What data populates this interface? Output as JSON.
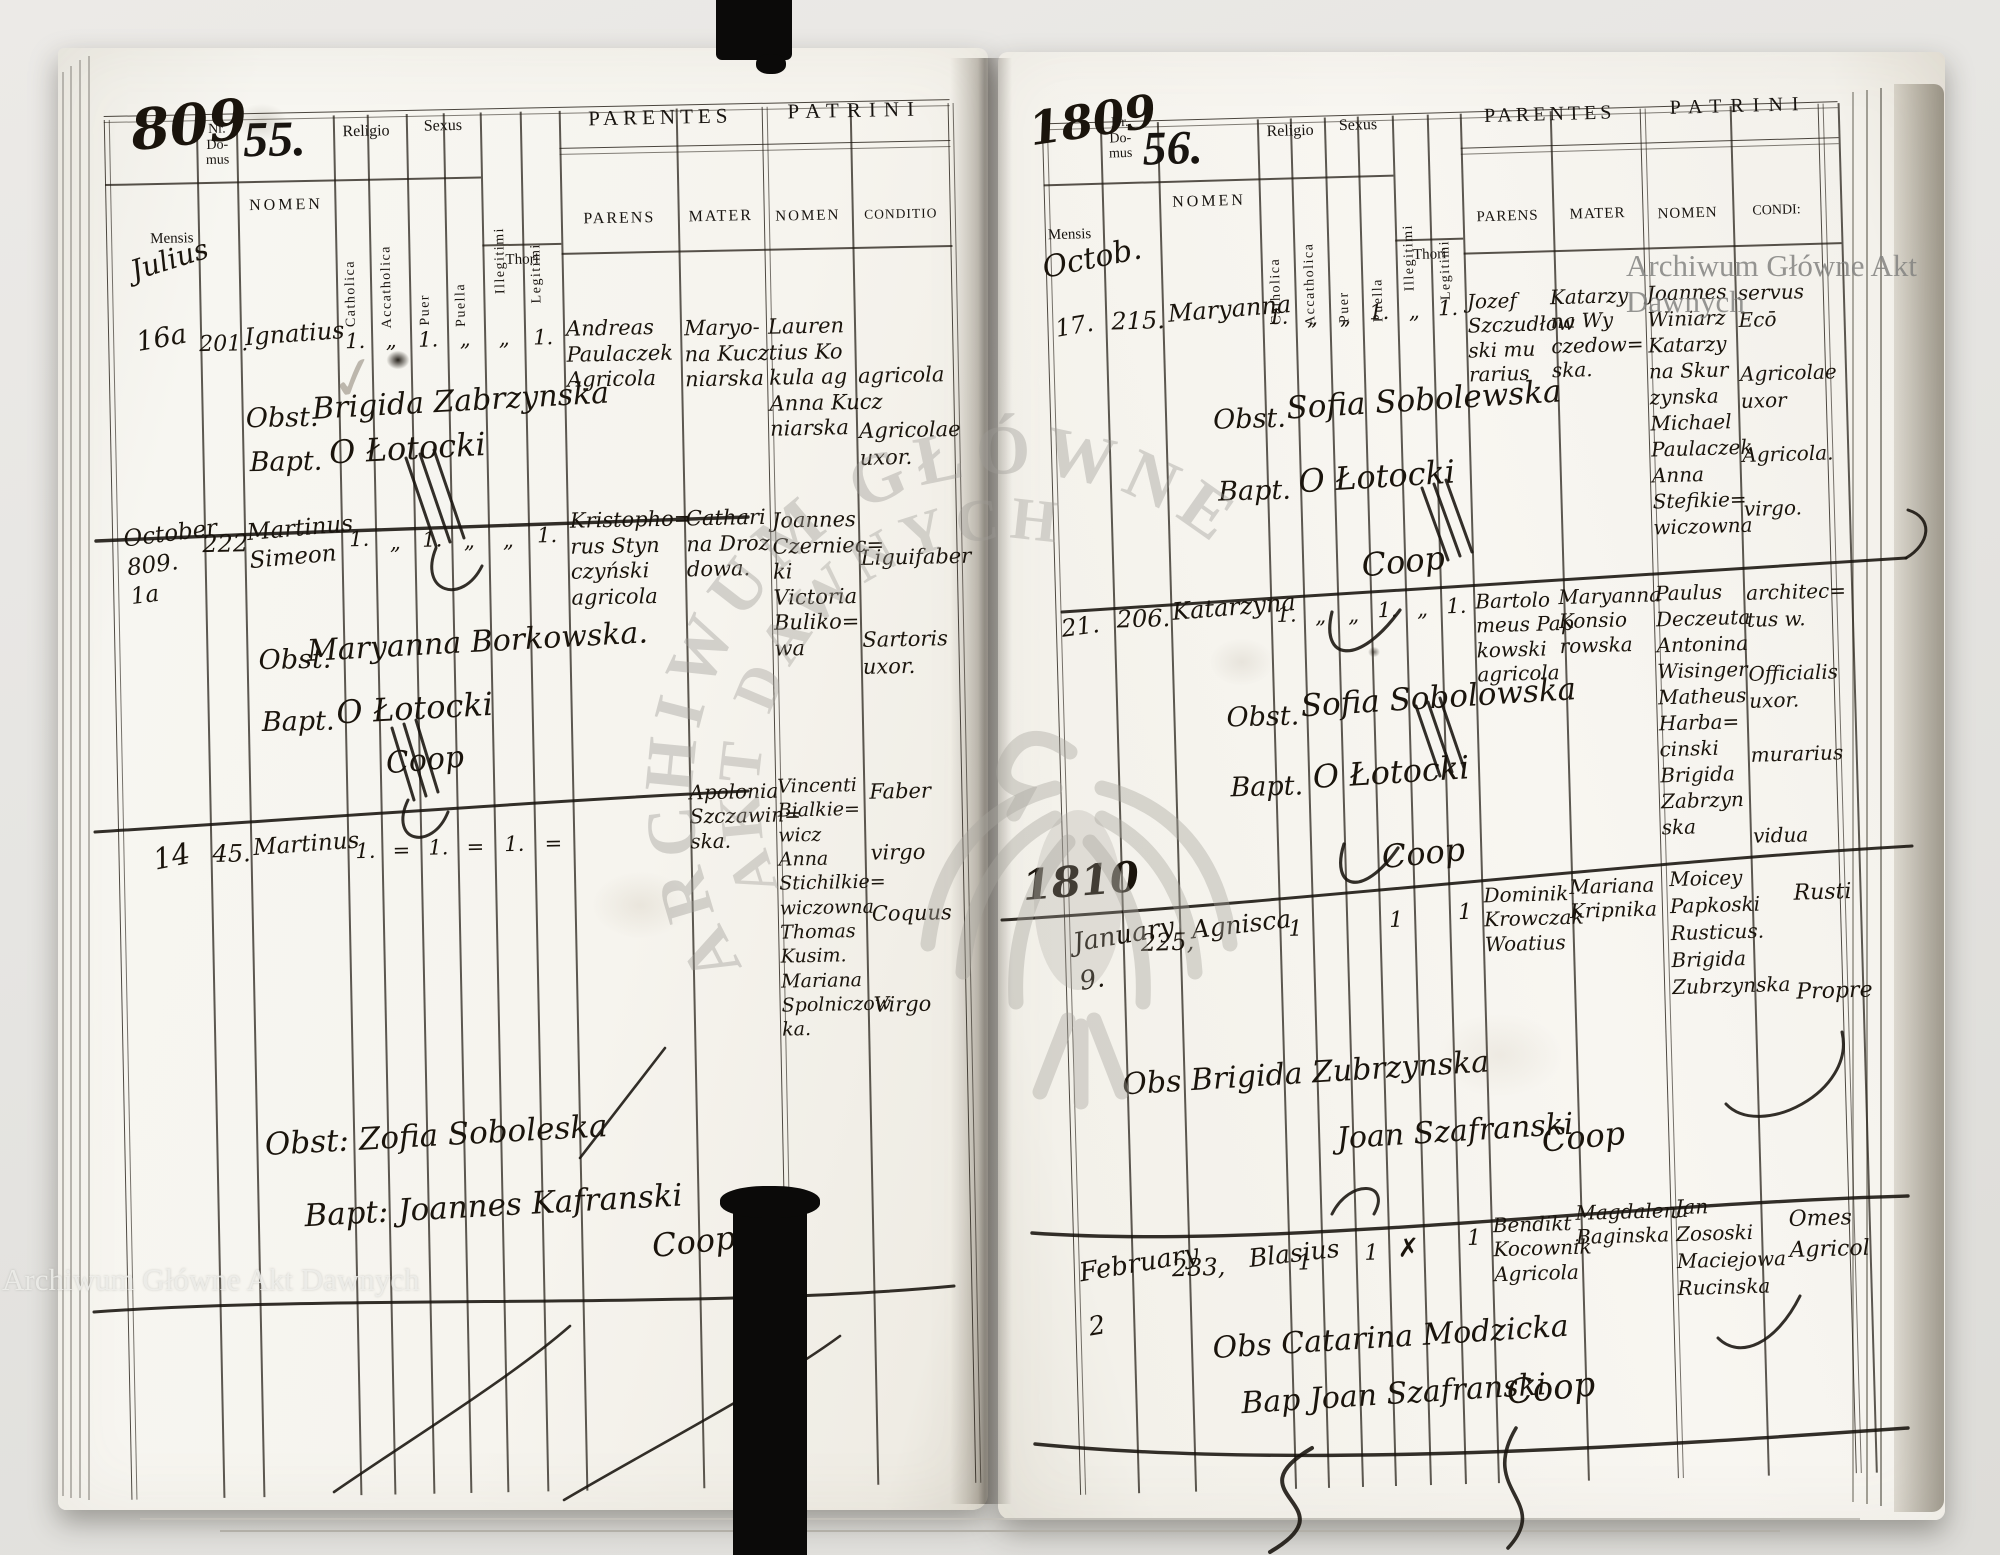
{
  "watermarks": {
    "archive_name_top": "Archiwum Główne Akt Dawnych",
    "archive_name_bottom": "Archiwum Główne Akt Dawnych",
    "seal_text_line1": "ARCHIWUM GŁÓWNE",
    "seal_text_line2": "AKT DAWNYCH"
  },
  "left_page": {
    "folio_handwritten": "809",
    "record_number": "55.",
    "mensis_value": "Julius",
    "column_headers": {
      "nr_domus": "Nr.\nDo-\nmus",
      "mensis": "Mensis",
      "nomen": "NOMEN",
      "religio": "Religio",
      "sexus": "Sexus",
      "catholica": "Catholica",
      "accatholica": "Accatholica",
      "puer": "Puer",
      "puella": "Puella",
      "illegitimi": "Illegitimi",
      "legitimi": "Legitimi",
      "thori": "Thori",
      "parentes": "PARENTES",
      "patrini": "PATRINI",
      "parens": "PARENS",
      "mater": "MATER",
      "patrini_nomen": "NOMEN",
      "conditio": "CONDITIO"
    },
    "entries": [
      {
        "dies": "16a",
        "nr_domus": "201.",
        "nomen": "Ignatius",
        "review_mark": "✓",
        "marks": [
          "1.",
          "„",
          "1.",
          "„",
          "„",
          "1."
        ],
        "parens": "Andreas\nPaulaczek\nAgricola",
        "mater": "Maryo-\nna Kucz\nniarska",
        "patrini_nomen": "Lauren\ntius Ko\nkula ag\nAnna Kucz\nniarska",
        "patrini_conditio": "agricola\n\nAgricolae\nuxor.",
        "obstetrix_label": "Obst.",
        "obstetrix": "Brigida Zabrzynska",
        "baptizans_label": "Bapt.",
        "baptizans": "O Łotocki"
      },
      {
        "dies": "October\n809.\n1a",
        "nr_domus": "222",
        "nomen": "Martinus\nSimeon",
        "marks": [
          "1.",
          "„",
          "1.",
          "„",
          "„",
          "1."
        ],
        "parens": "Kristopho=\nrus Styn\nczyński\nagricola",
        "mater": "Cathari\nna Droz\ndowa.",
        "patrini_nomen": "Joannes\nCzerniec=\nki\nVictoria\nBuliko=\nwa",
        "patrini_conditio": "Liguifaber\n\n\nSartoris\nuxor.",
        "obstetrix_label": "Obst.",
        "obstetrix": "Maryanna Borkowska.",
        "baptizans_label": "Bapt.",
        "baptizans": "O Łotocki",
        "coop": "Coop"
      },
      {
        "dies": "14",
        "nr_domus": "45.",
        "nomen": "Martinus",
        "marks": [
          "1.",
          "=",
          "1.",
          "=",
          "1.",
          "="
        ],
        "parens": "",
        "mater": "Apolonia\nSzczawin=\nska.",
        "patrini_nomen": "Vincenti\nBialkie=\nwicz\nAnna\nStichilkie=\nwiczowna\nThomas\nKusim.\nMariana\nSpolniczow\nka.",
        "patrini_conditio": "Faber\n\nvirgo\n\nCoquus\n\n\nVirgo"
      }
    ],
    "lower_note_obstetrix": "Obst:  Zofia Soboleska",
    "lower_note_baptizans": "Bapt:  Joannes Kafranski",
    "lower_note_coop": "Coop"
  },
  "right_page": {
    "folio_handwritten": "1809",
    "record_number": "56.",
    "mensis_value": "Octob.",
    "year_divider": "1810",
    "column_headers": {
      "nr_domus": "Nr.\nDo-\nmus",
      "mensis": "Mensis",
      "nomen": "NOMEN",
      "religio": "Religio",
      "sexus": "Sexus",
      "catholica": "Catholica",
      "accatholica": "Accatholica",
      "puer": "Puer",
      "puella": "Puella",
      "illegitimi": "Illegitimi",
      "legitimi": "Legitimi",
      "thori": "Thori",
      "parentes": "PARENTES",
      "patrini": "PATRINI",
      "parens": "PARENS",
      "mater": "MATER",
      "patrini_nomen": "NOMEN",
      "conditio": "CONDI:"
    },
    "entries": [
      {
        "dies": "17.",
        "nr_domus": "215.",
        "nomen": "Maryanna",
        "marks": [
          "1.",
          "„",
          "„",
          "1.",
          "„",
          "1."
        ],
        "parens": "Jozef\nSzczudłow\nski mu\nrarius",
        "mater": "Katarzy\nna Wy\nczedow=\nska.",
        "patrini_nomen": "Joannes\nWiniarz\nKatarzy\nna Skur\nzynska\nMichael\nPaulaczek\nAnna\nStefikie=\nwiczowna",
        "patrini_conditio": "servus\nEcō\n\nAgricolae\nuxor\n\nAgricola.\n\nvirgo.",
        "obstetrix_label": "Obst.",
        "obstetrix": "Sofia Sobolewska",
        "baptizans_label": "Bapt.",
        "baptizans": "O Łotocki",
        "coop": "Coop"
      },
      {
        "dies": "21.",
        "nr_domus": "206.",
        "nomen": "Katarzyna",
        "marks": [
          "1.",
          "„",
          "„",
          "1.",
          "„",
          "1."
        ],
        "parens": "Bartolo\nmeus Pap\nkowski\nagricola",
        "mater": "Maryanna\nKonsio\nrowska",
        "patrini_nomen": "Paulus\nDeczeuta\nAntonina\nWisinger\nMatheus\nHarba=\ncinski\nBrigida\nZabrzyn\nska",
        "patrini_conditio": "architec=\ntus w.\n\nOfficialis\nuxor.\n\nmurarius\n\n\nvidua",
        "obstetrix_label": "Obst.",
        "obstetrix": "Sofia Sobolowska",
        "baptizans_label": "Bapt.",
        "baptizans": "O Łotocki",
        "coop": "Coop"
      },
      {
        "dies": "January\n9.",
        "nr_domus": "225,",
        "nomen": "Agnisca",
        "marks": [
          "1",
          "1",
          "1"
        ],
        "parens": "Dominik\nKrowczak\nWoatius",
        "mater": "Mariana\nKripnika",
        "patrini_nomen": "Moicey\nPapkoski\nRusticus.\nBrigida\nZubrzynska",
        "patrini_conditio": "Rusti\n\n\nPropre",
        "obstetrix": "Obs Brigida Zubrzynska",
        "baptizans": "Joan Szafranski",
        "coop": "Coop"
      },
      {
        "dies": "February\n2",
        "nr_domus": "233,",
        "nomen": "Blasius",
        "marks": [
          "1",
          "1",
          "✗",
          "1"
        ],
        "parens": "Bendikt\nKocownik\nAgricola",
        "mater": "Magdalena\nBaginska",
        "patrini_nomen": "Jan\nZososki\nMaciejowa\nRucinska",
        "patrini_conditio": "Omes\nAgricol",
        "obstetrix": "Obs Catarina Modzicka",
        "baptizans": "Bap Joan Szafranski",
        "coop": "Coop"
      }
    ]
  }
}
